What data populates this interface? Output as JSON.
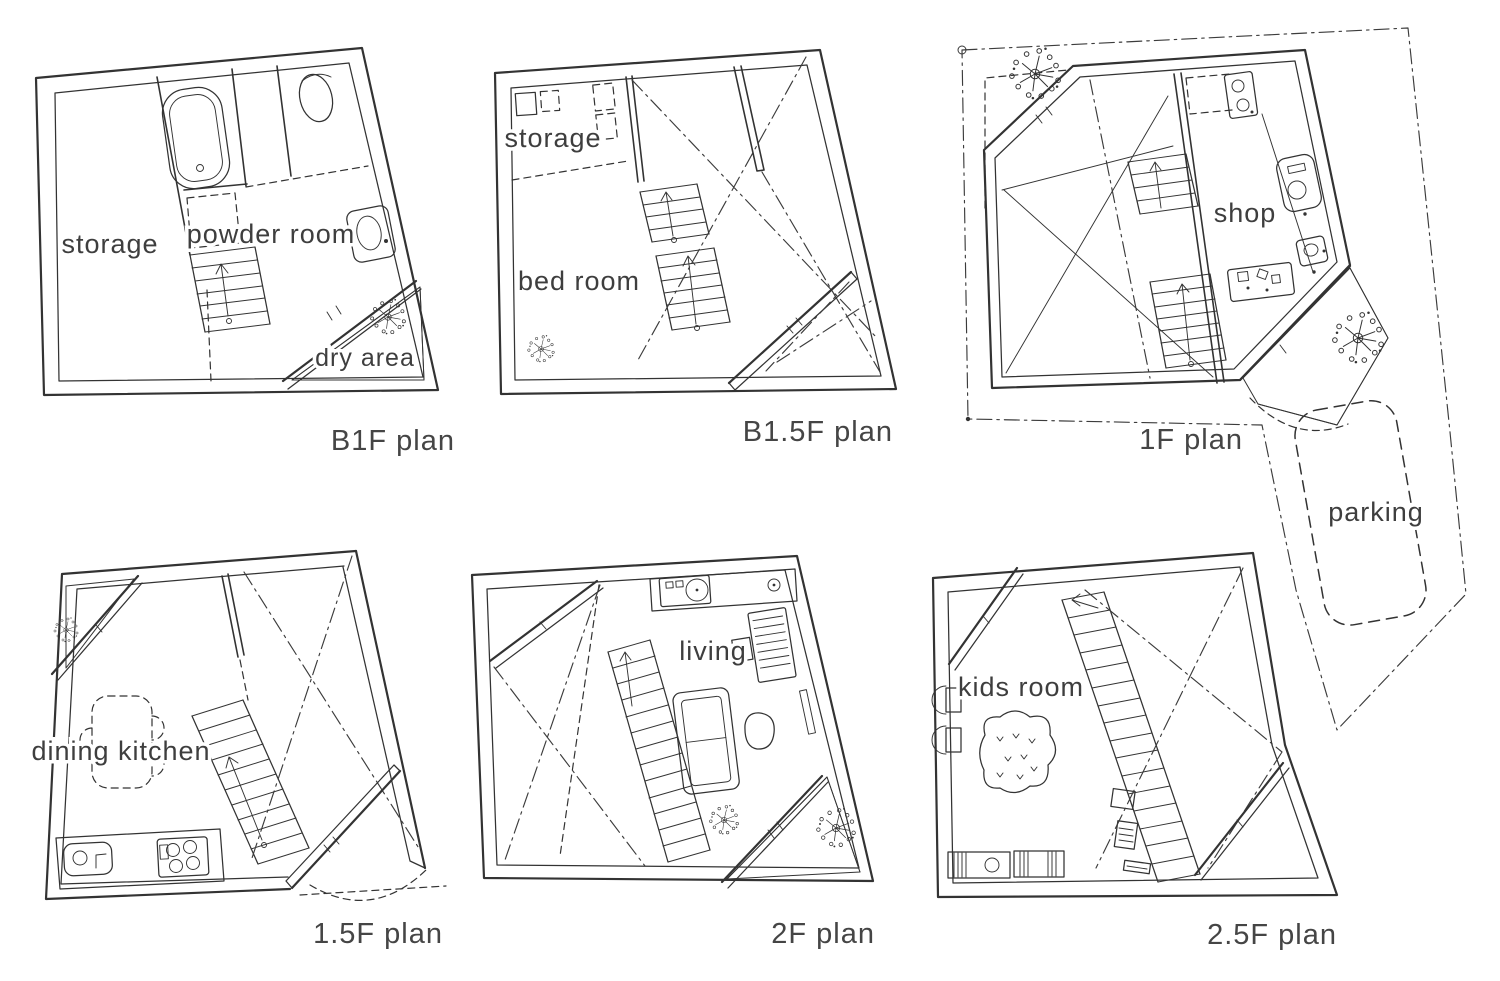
{
  "figure": {
    "background": "#ffffff",
    "ink_color": "#333333",
    "label_color": "#3e3e3e"
  },
  "panels": [
    {
      "id": "b1f",
      "title": "B1F plan",
      "rooms": {
        "storage": "storage",
        "powder_room": "powder room",
        "dry_area": "dry area"
      }
    },
    {
      "id": "b1_5f",
      "title": "B1.5F plan",
      "rooms": {
        "storage": "storage",
        "bed_room": "bed room"
      }
    },
    {
      "id": "1f",
      "title": "1F plan",
      "rooms": {
        "shop": "shop",
        "parking": "parking"
      }
    },
    {
      "id": "1_5f",
      "title": "1.5F plan",
      "rooms": {
        "dining_kitchen": "dining kitchen"
      }
    },
    {
      "id": "2f",
      "title": "2F plan",
      "rooms": {
        "living": "living"
      }
    },
    {
      "id": "2_5f",
      "title": "2.5F plan",
      "rooms": {
        "kids_room": "kids room"
      }
    }
  ]
}
